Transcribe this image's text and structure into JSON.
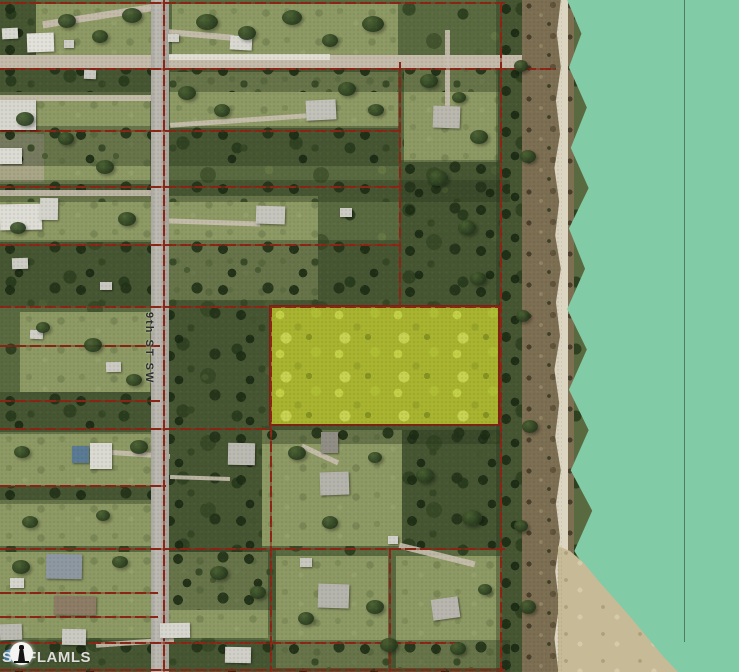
{
  "map": {
    "description": "aerial parcel map with highlighted lot beside lake",
    "street_label": "9th ST SW",
    "watermark_text": "SWFLAMLS"
  },
  "icons": {
    "watermark_icon": "lighthouse-icon"
  },
  "colors": {
    "water_teal": "#81cba6",
    "highlight_yellow": "#a9b42f",
    "boundary_red": "#8b2516",
    "road_gray": "#b3b1a9",
    "vegetation_green": "#5a6a40",
    "grass_light": "#8e9a64",
    "beach_brown": "#7d6f52",
    "sand_white": "#dbd5c1",
    "sandbar_tan": "#c7ba96",
    "watermark_white": "#eaeae8",
    "street_label_color": "#2e2e2e"
  }
}
